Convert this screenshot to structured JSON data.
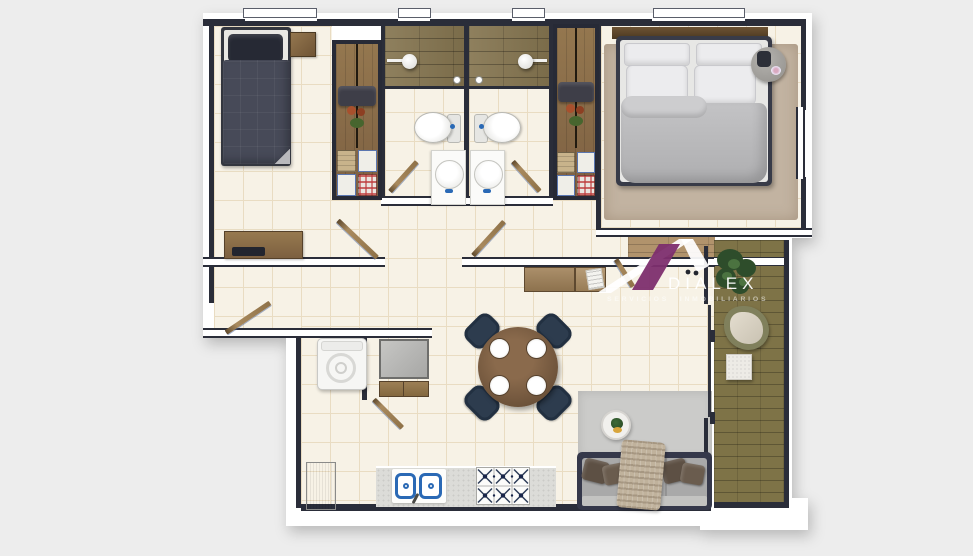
{
  "watermark": {
    "brand": "DIALEX",
    "tagline": "SERVICIOS INMOBILIARIOS"
  },
  "palette": {
    "background": "#ededed",
    "wall_fill": "#ffffff",
    "wall_line": "#2a2d39",
    "floor_tile": "#f7f2e6",
    "tile_grout": "#e9dcc2",
    "shower_wood": "#857550",
    "balcony_deck": "#7e7347",
    "hall_oak": "#b1936c",
    "wardrobe_wood": "#8a6e4b",
    "dark_furniture": "#343747",
    "master_duvet": "#b8b8ba",
    "rug_beige": "#c2b3a1",
    "rug_gray": "#cbcbc9",
    "sofa_gray": "#a6a6a6",
    "pillow_brown": "#5d5044",
    "dining_chair_navy": "#2d3c4e",
    "table_wood": "#7a5c42",
    "counter_gray": "#dcdcd8",
    "sink_blue": "#2a69b5",
    "logo_purple": "#7d2e6e"
  }
}
